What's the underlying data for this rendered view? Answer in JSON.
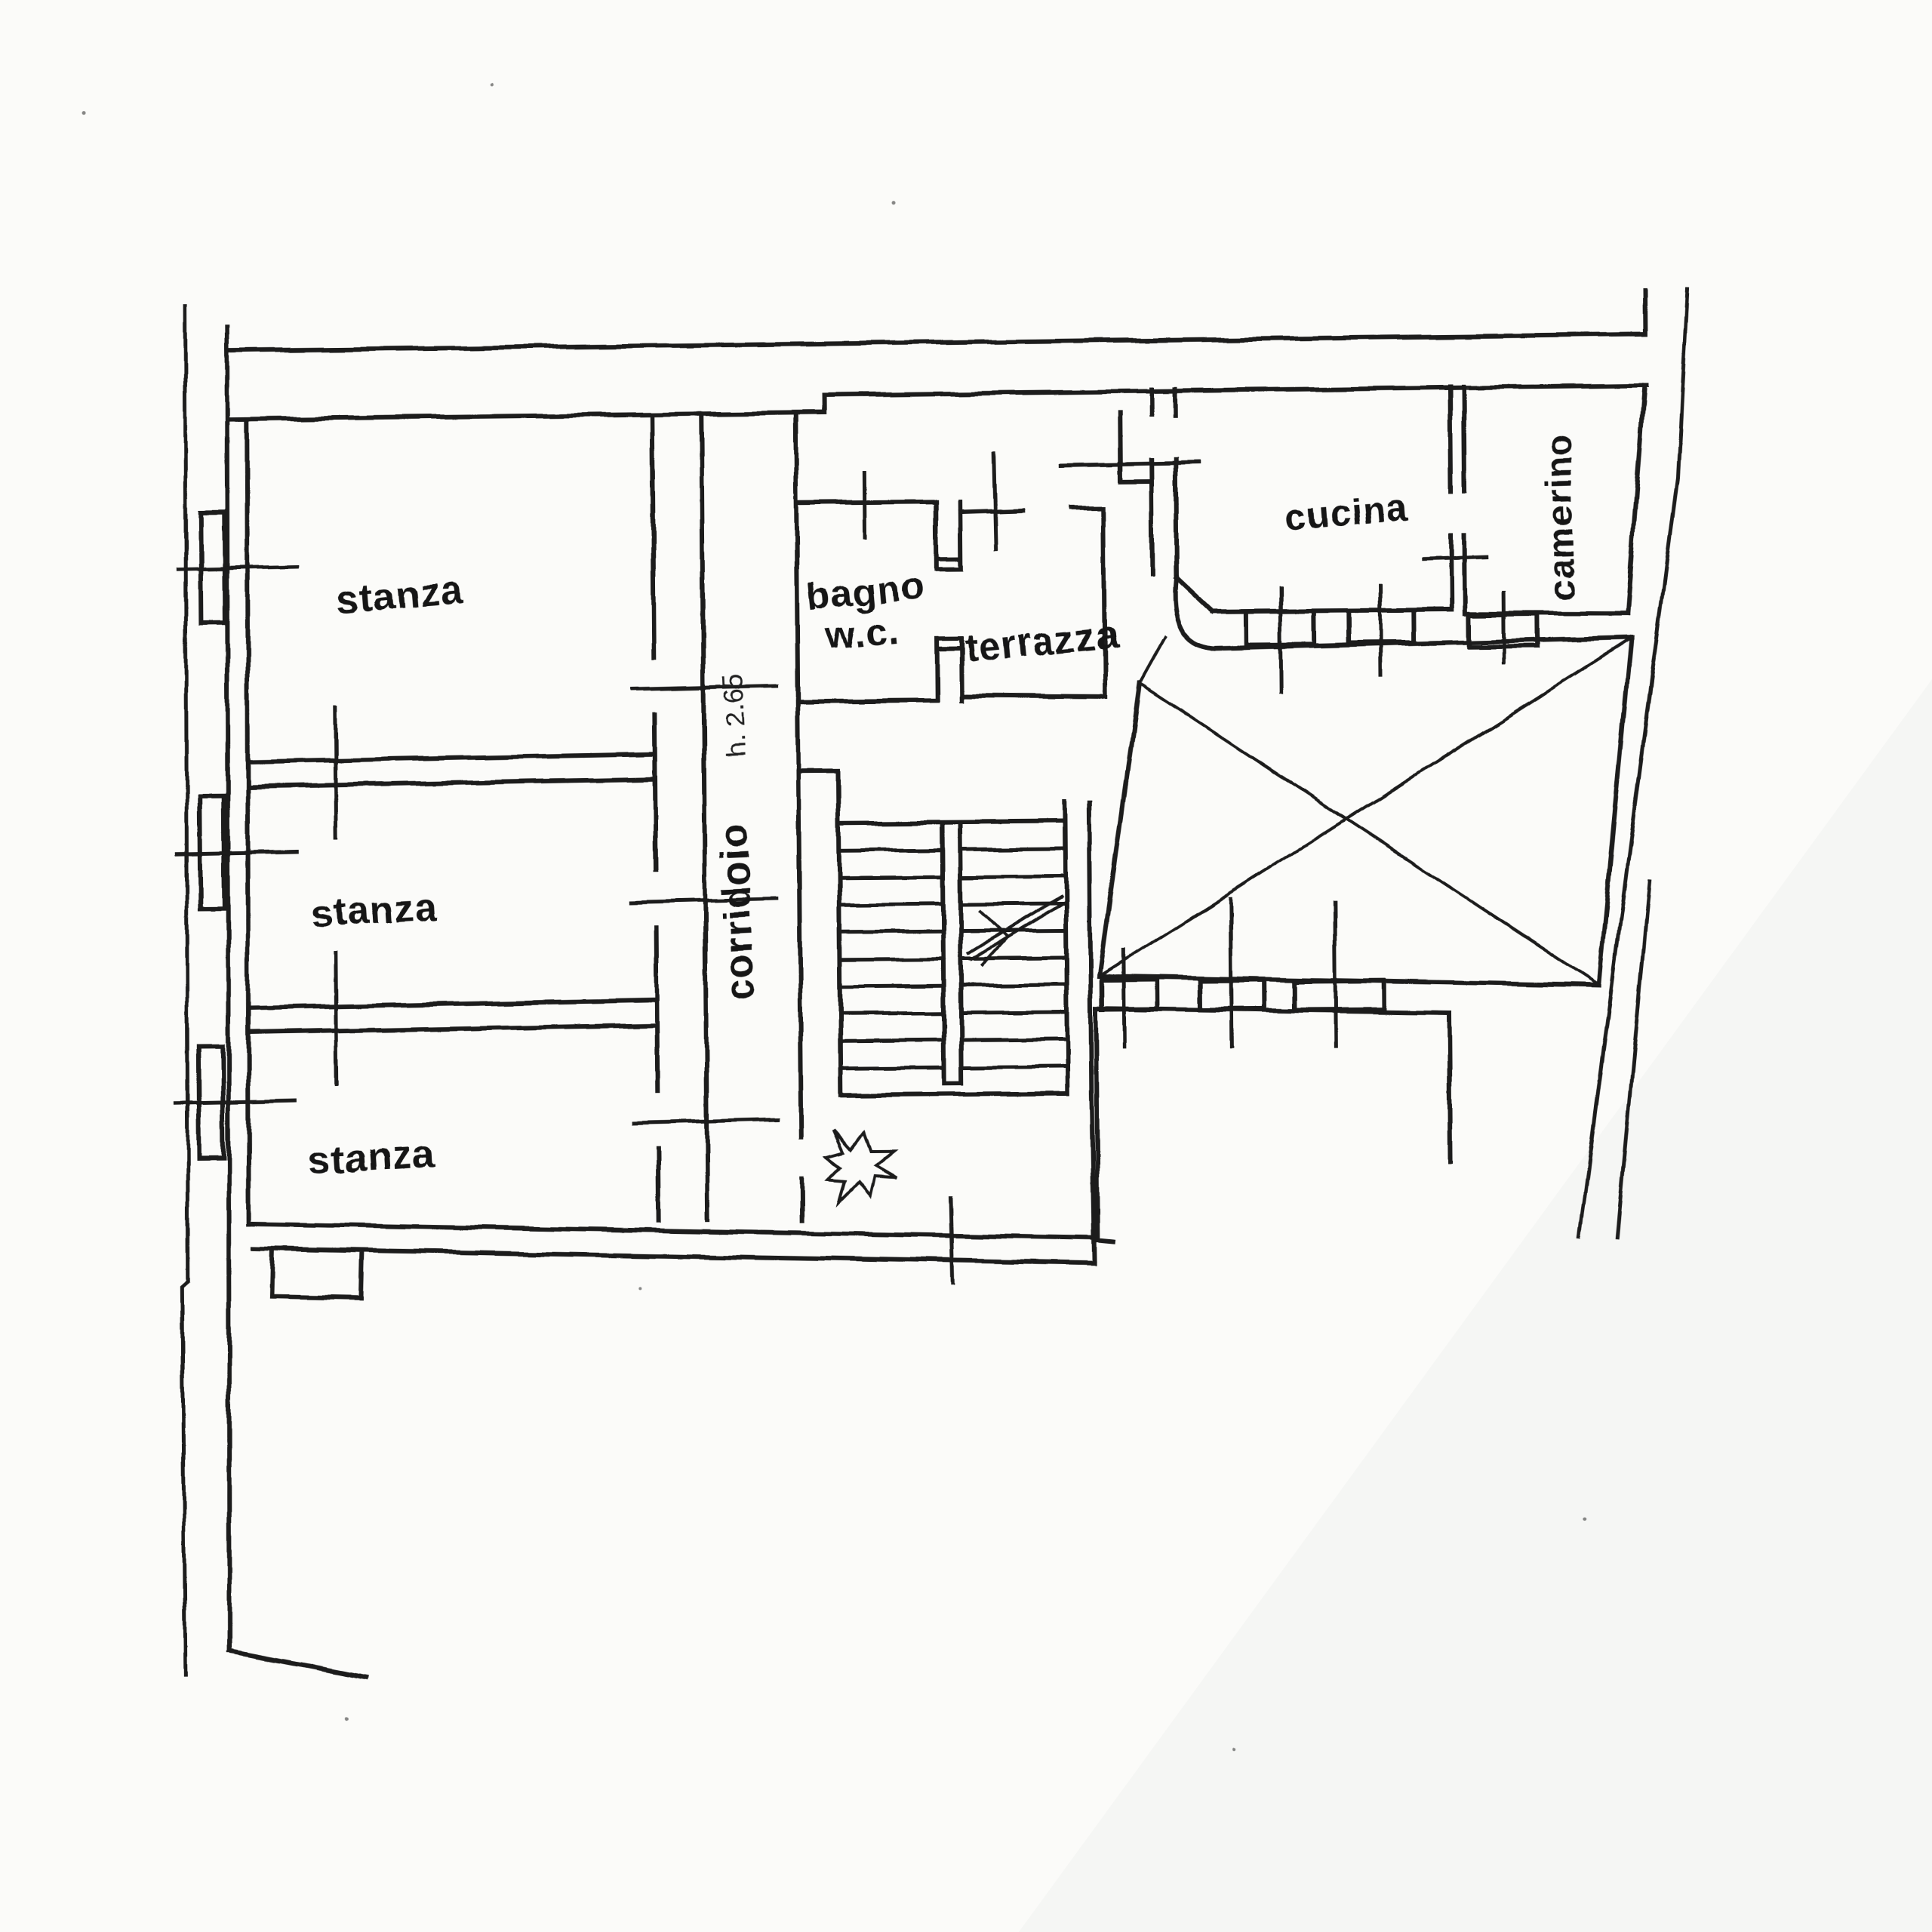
{
  "colors": {
    "ink": "#1a1a1a",
    "paper": "#fbfbf9"
  },
  "plan": {
    "room_labels": {
      "stanza_top": "stanza",
      "stanza_middle": "stanza",
      "stanza_bottom": "stanza",
      "corridoio": "corridoio",
      "bagno_line1": "bagno",
      "bagno_line2": "w.c.",
      "terrazza": "terrazza",
      "cucina": "cucina",
      "camerino": "camerino"
    },
    "annotations": {
      "ceiling_height": "h. 2.65"
    }
  }
}
